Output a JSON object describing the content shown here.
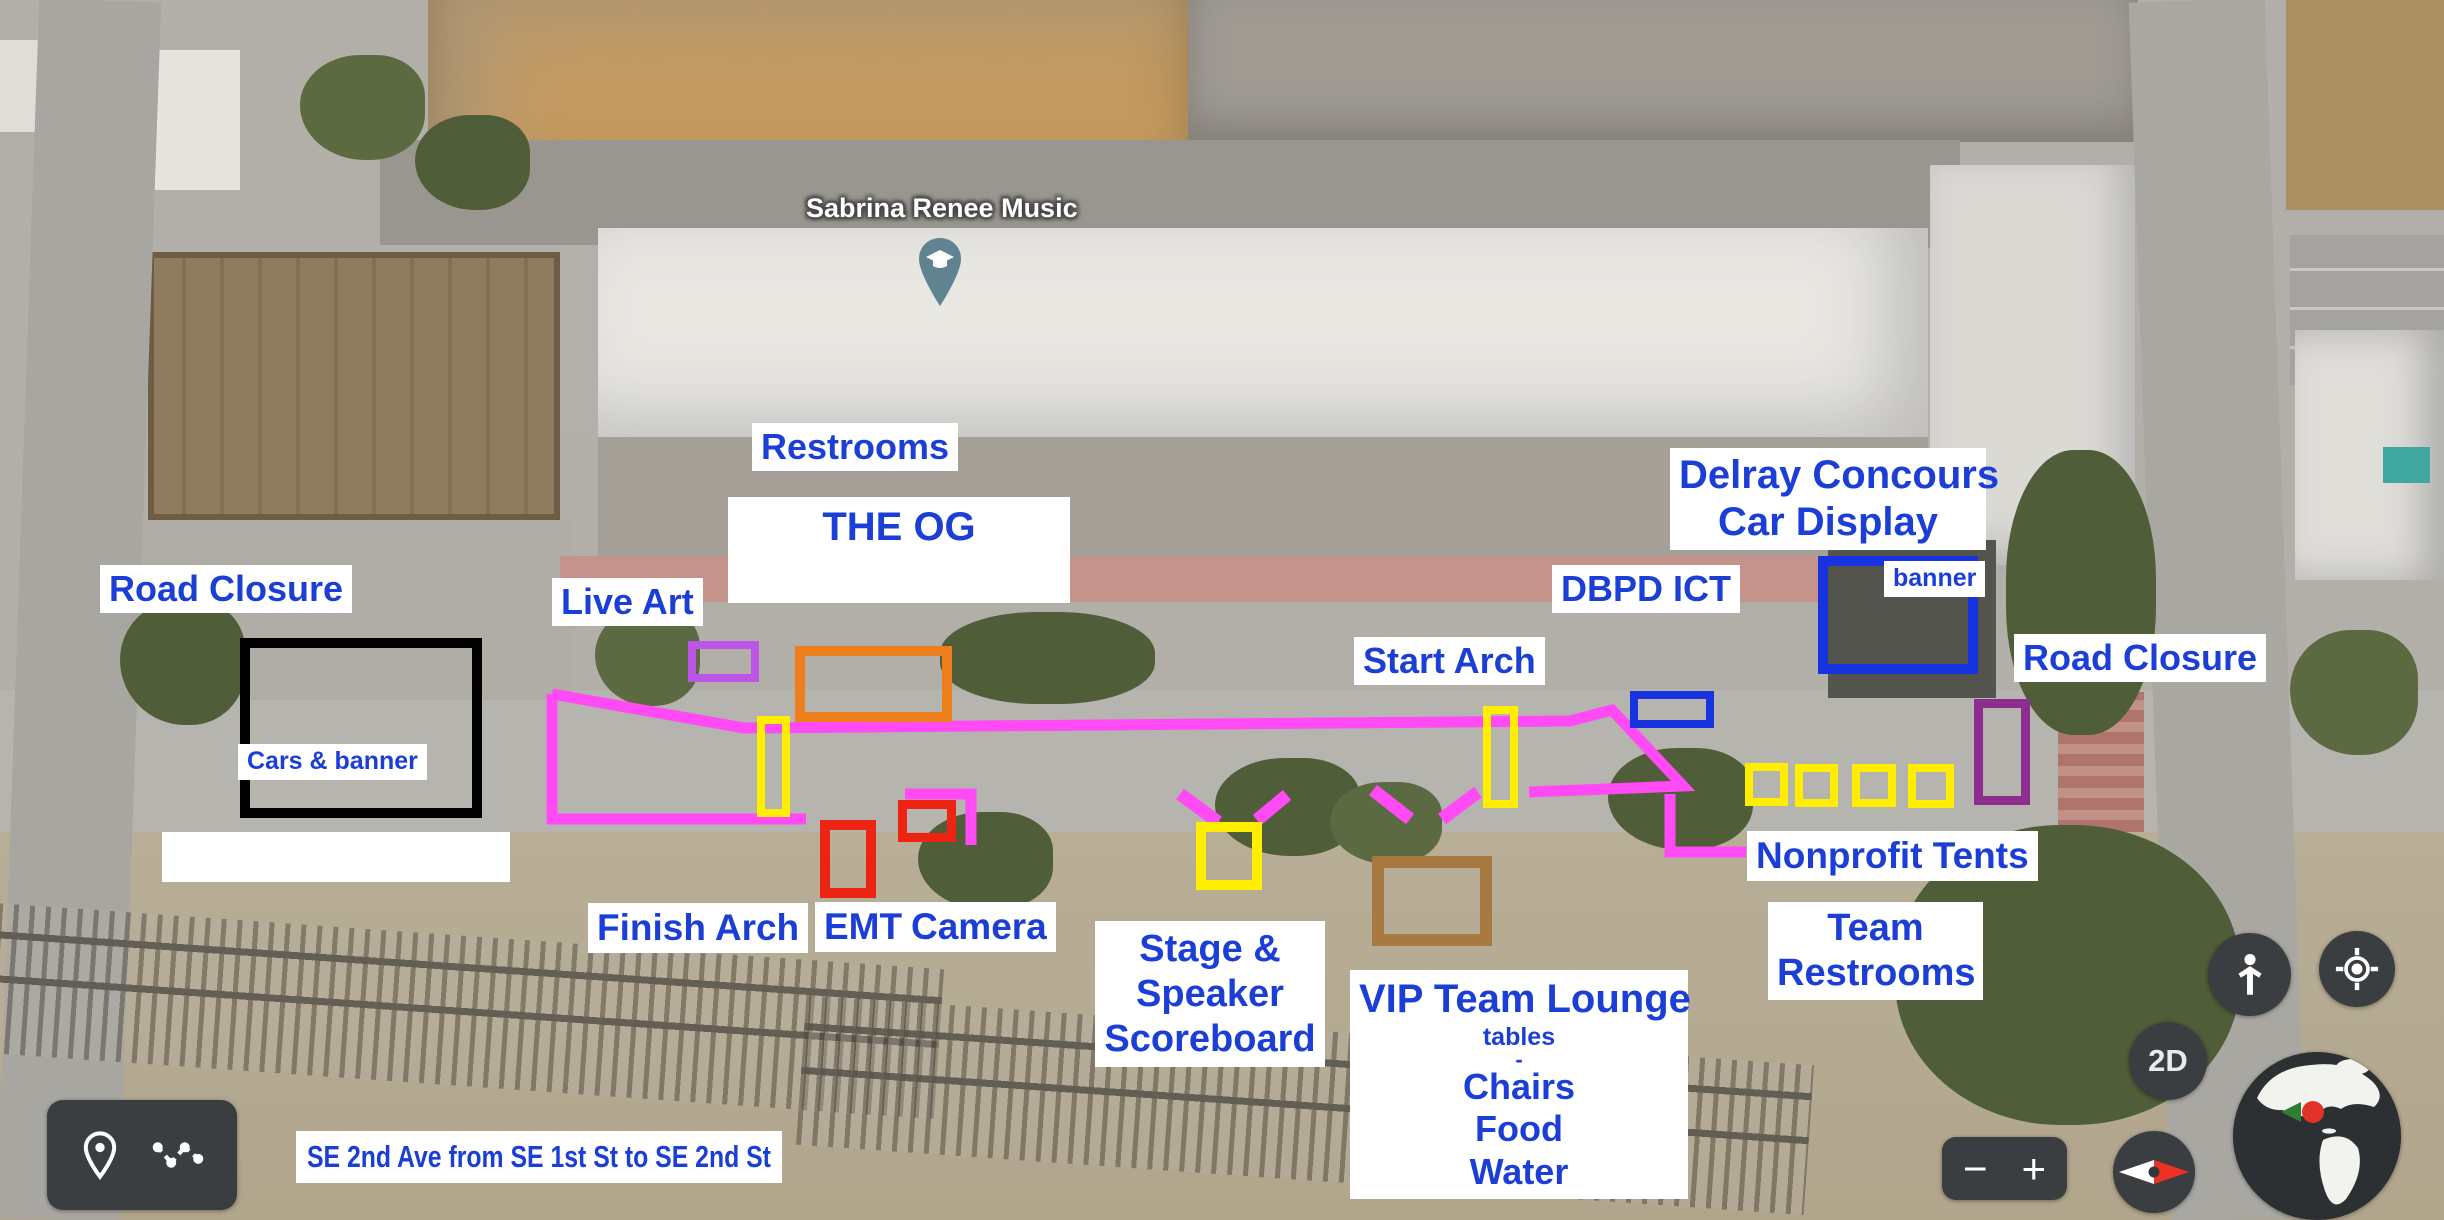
{
  "place": {
    "name": "Sabrina Renee Music"
  },
  "labels": {
    "road_closure_left": "Road Closure",
    "cars_banner": "Cars & banner",
    "live_art": "Live Art",
    "restrooms": "Restrooms",
    "the_og": "THE OG",
    "finish_arch": "Finish Arch",
    "emt": "EMT",
    "camera": "Camera",
    "stage_line1": "Stage &",
    "stage_line2": "Speaker",
    "stage_line3": "Scoreboard",
    "vip_title": "VIP Team Lounge",
    "vip_tables": "tables",
    "vip_dash": "-",
    "vip_chairs": "Chairs",
    "vip_food": "Food",
    "vip_water": "Water",
    "start_arch": "Start Arch",
    "dbpd_ict": "DBPD ICT",
    "delray_line1": "Delray Concours",
    "delray_line2": "Car Display",
    "banner": "banner",
    "road_closure_right": "Road Closure",
    "nonprofit_tents": "Nonprofit Tents",
    "team_line1": "Team",
    "team_line2": "Restrooms",
    "street_note": "SE 2nd Ave from SE 1st St to SE 2nd St"
  },
  "ui": {
    "zoom_out": "−",
    "zoom_in": "+",
    "mode": "2D"
  },
  "colors": {
    "label_blue": "#1b3fd6",
    "label_bg": "#ffffff",
    "magenta": "#ff4af5",
    "violet": "#bc54e6",
    "purple": "#8e2d90",
    "orange": "#ee7d1b",
    "yellow": "#ffee00",
    "red": "#ee2412",
    "brown": "#a5793f",
    "blue_box": "#1733e0",
    "black": "#000000",
    "ui_dark": "#3b3e41",
    "pin_teal": "#5f8390"
  }
}
